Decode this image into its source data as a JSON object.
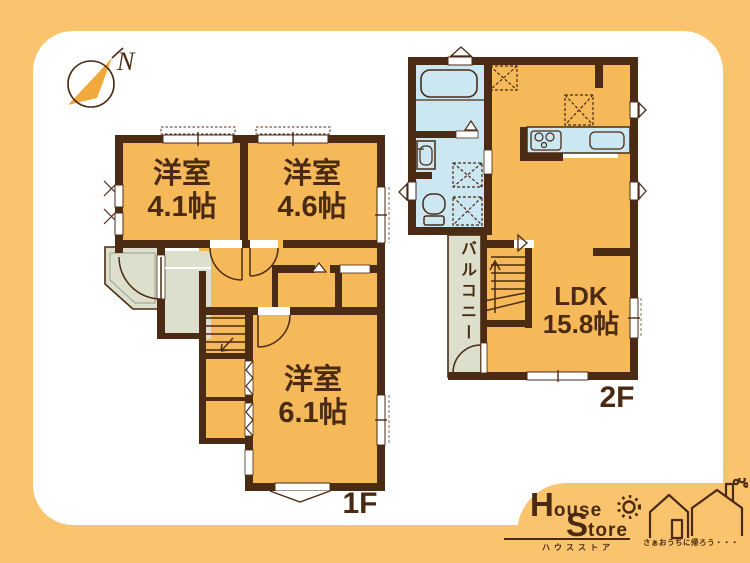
{
  "colors": {
    "page_bg": "#F9C46D",
    "room_fill": "#F6B95A",
    "wall": "#4B2B14",
    "water_area_fill": "#CBE7F2",
    "balcony_fill": "#DCDFCB",
    "text": "#4A2A12",
    "compass_needle": "#F2A93B"
  },
  "compass": {
    "north_label": "N"
  },
  "floor1": {
    "label": "1F",
    "rooms": [
      {
        "name": "洋室",
        "size": "4.1帖"
      },
      {
        "name": "洋室",
        "size": "4.6帖"
      },
      {
        "name": "洋室",
        "size": "6.1帖"
      }
    ]
  },
  "floor2": {
    "label": "2F",
    "ldk": {
      "name": "LDK",
      "size": "15.8帖"
    },
    "balcony_label": "バルコニー"
  },
  "logo": {
    "word1_initial": "H",
    "word1_rest": "ouse",
    "word2_initial": "S",
    "word2_rest": "tore",
    "katakana": "ハウスストア",
    "tagline": "さぁおうちに帰ろう・・・"
  }
}
